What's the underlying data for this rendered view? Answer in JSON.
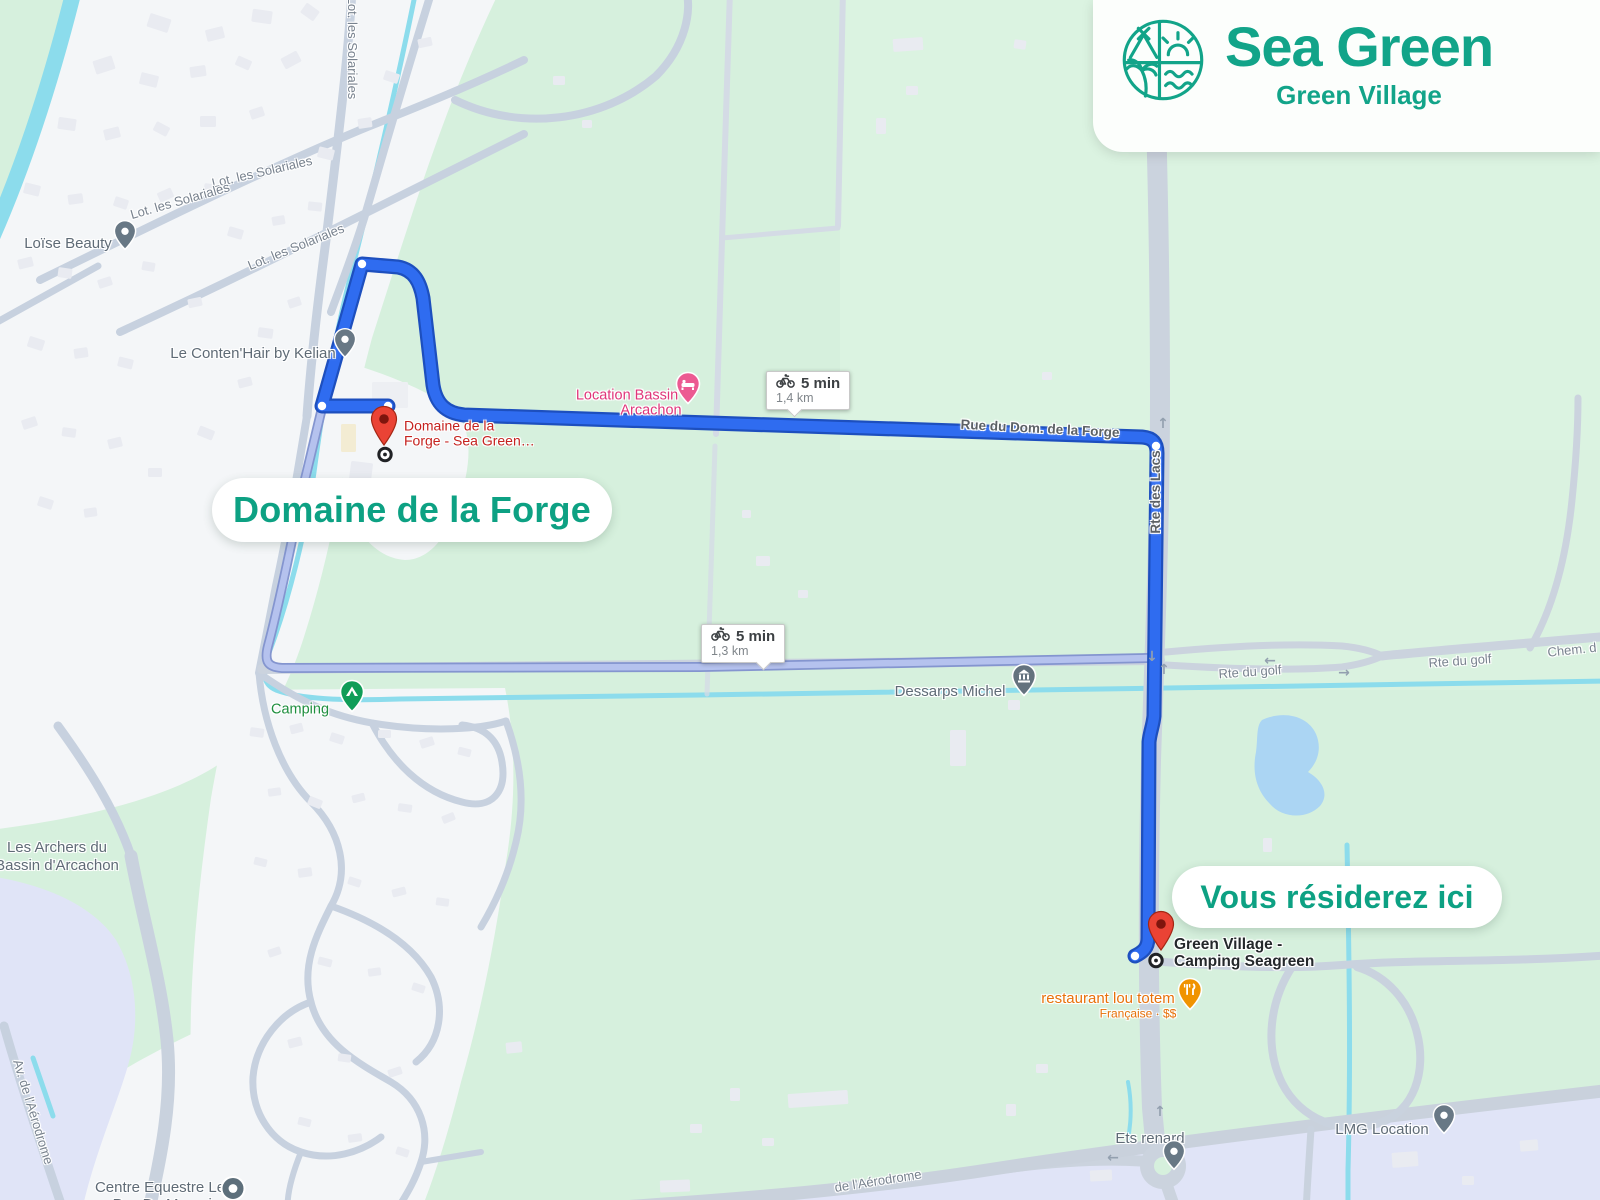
{
  "brand_card": {
    "title": "Sea Green",
    "subtitle": "Green Village",
    "accent_color": "#12a489"
  },
  "callout_pills": [
    {
      "id": "origin",
      "text": "Domaine de la Forge",
      "x": 212,
      "y": 478,
      "w": 400,
      "h": 64,
      "size": "pill-lg"
    },
    {
      "id": "destination",
      "text": "Vous résiderez ici",
      "x": 1172,
      "y": 866,
      "w": 330,
      "h": 62,
      "size": "pill-md"
    }
  ],
  "route_badges": [
    {
      "id": "route-primary-badge",
      "mode": "bicycle",
      "duration": "5 min",
      "distance": "1,4 km",
      "x": 766,
      "y": 371,
      "tail_x": 22
    },
    {
      "id": "route-alternate-badge",
      "mode": "bicycle",
      "duration": "5 min",
      "distance": "1,3 km",
      "x": 701,
      "y": 624,
      "tail_x": 56
    }
  ],
  "markers": [
    {
      "id": "origin-pin",
      "type": "red-pin",
      "x": 384,
      "y": 452
    },
    {
      "id": "origin-ring",
      "type": "target-ring",
      "x": 385,
      "y": 457
    },
    {
      "id": "destination-pin",
      "type": "red-pin",
      "x": 1161,
      "y": 957
    },
    {
      "id": "destination-ring",
      "type": "target-ring",
      "x": 1156,
      "y": 963
    },
    {
      "id": "poi-loise-beauty",
      "type": "gray-pin",
      "x": 125,
      "y": 256
    },
    {
      "id": "poi-contenhair",
      "type": "gray-pin",
      "x": 345,
      "y": 364
    },
    {
      "id": "poi-location-bassin",
      "type": "pink-lodging-pin",
      "x": 688,
      "y": 410
    },
    {
      "id": "poi-dessarps",
      "type": "gray-bank-pin",
      "x": 1024,
      "y": 702
    },
    {
      "id": "poi-camping",
      "type": "green-camping-pin",
      "x": 352,
      "y": 718
    },
    {
      "id": "poi-restaurant",
      "type": "orange-restaurant-pin",
      "x": 1190,
      "y": 1016
    },
    {
      "id": "poi-ets-renard",
      "type": "gray-pin",
      "x": 1174,
      "y": 1176
    },
    {
      "id": "poi-lmg",
      "type": "gray-pin",
      "x": 1444,
      "y": 1140
    },
    {
      "id": "poi-centre-equestre",
      "type": "gray-dot-pin",
      "x": 233,
      "y": 1191
    }
  ],
  "map_labels": [
    {
      "name": "street-lot-les-solariales-1",
      "text": "Lot. les Solariales",
      "x": 352,
      "y": 48,
      "rot": 90,
      "cls": "street"
    },
    {
      "name": "street-lot-les-solariales-2",
      "text": "Lot. les Solariales",
      "x": 262,
      "y": 172,
      "rot": -13,
      "cls": "street"
    },
    {
      "name": "street-lot-les-solariales-3",
      "text": "Lot. les Solariales",
      "x": 180,
      "y": 201,
      "rot": -16,
      "cls": "street"
    },
    {
      "name": "street-lot-les-solariales-4",
      "text": "Lot. les Solariales",
      "x": 296,
      "y": 247,
      "rot": -22,
      "cls": "street"
    },
    {
      "name": "street-rue-du-dom-de-la-forge",
      "text": "Rue du Dom. de la Forge",
      "x": 1040,
      "y": 429,
      "rot": 3,
      "cls": "street on-route"
    },
    {
      "name": "street-rte-des-lacs",
      "text": "Rte des Lacs",
      "x": 1156,
      "y": 492,
      "rot": -90,
      "cls": "street on-route"
    },
    {
      "name": "street-rte-du-golf-1",
      "text": "Rte du golf",
      "x": 1250,
      "y": 672,
      "rot": -4,
      "cls": "street"
    },
    {
      "name": "street-rte-du-golf-2",
      "text": "Rte du golf",
      "x": 1460,
      "y": 661,
      "rot": -4,
      "cls": "street"
    },
    {
      "name": "street-chem-d",
      "text": "Chem. d",
      "x": 1572,
      "y": 650,
      "rot": -6,
      "cls": "street"
    },
    {
      "name": "street-av-aerodrome",
      "text": "Av. de l'Aérodrome",
      "x": 33,
      "y": 1112,
      "rot": 73,
      "cls": "street"
    },
    {
      "name": "street-de-aerodrome",
      "text": "de l'Aérodrome",
      "x": 878,
      "y": 1181,
      "rot": -9,
      "cls": "street"
    },
    {
      "name": "poi-label-loise-beauty",
      "text": "Loïse Beauty",
      "x": 68,
      "y": 244,
      "cls": "poi"
    },
    {
      "name": "poi-label-contenhair",
      "text": "Le Conten'Hair by Kelian",
      "x": 253,
      "y": 354,
      "cls": "poi"
    },
    {
      "name": "poi-label-dessarps",
      "text": "Dessarps Michel",
      "x": 950,
      "y": 692,
      "cls": "poi"
    },
    {
      "name": "poi-label-les-archers-1",
      "text": "Les Archers du",
      "x": 57,
      "y": 848,
      "cls": "poi"
    },
    {
      "name": "poi-label-les-archers-2",
      "text": "Bassin d'Arcachon",
      "x": 57,
      "y": 866,
      "cls": "poi"
    },
    {
      "name": "poi-label-camping",
      "text": "Camping",
      "x": 300,
      "y": 710,
      "cls": "green"
    },
    {
      "name": "poi-label-restaurant",
      "text": "restaurant lou totem",
      "x": 1108,
      "y": 999,
      "cls": "orange"
    },
    {
      "name": "poi-label-restaurant-2",
      "text": "Française · $$",
      "x": 1138,
      "y": 1014,
      "cls": "orange small"
    },
    {
      "name": "poi-label-ets-renard",
      "text": "Ets renard",
      "x": 1150,
      "y": 1139,
      "cls": "poi"
    },
    {
      "name": "poi-label-lmg",
      "text": "LMG Location",
      "x": 1382,
      "y": 1130,
      "cls": "poi"
    },
    {
      "name": "poi-label-centre-equestre-1",
      "text": "Centre Equestre Le",
      "x": 160,
      "y": 1188,
      "cls": "poi"
    },
    {
      "name": "poi-label-centre-equestre-2",
      "text": "Pas Du Marquis",
      "x": 166,
      "y": 1205,
      "cls": "poi"
    },
    {
      "name": "origin-marker-label-1",
      "text": "Domaine de la",
      "x": 404,
      "y": 426,
      "cls": "red left"
    },
    {
      "name": "origin-marker-label-2",
      "text": "Forge - Sea Green…",
      "x": 404,
      "y": 441,
      "cls": "red left"
    },
    {
      "name": "poi-label-location-bassin-1",
      "text": "Location Bassin",
      "x": 627,
      "y": 396,
      "cls": "pink"
    },
    {
      "name": "poi-label-location-bassin-2",
      "text": "Arcachon",
      "x": 651,
      "y": 411,
      "cls": "pink"
    },
    {
      "name": "destination-marker-label-1",
      "text": "Green Village -",
      "x": 1174,
      "y": 945,
      "cls": "dark left"
    },
    {
      "name": "destination-marker-label-2",
      "text": "Camping Seagreen",
      "x": 1174,
      "y": 962,
      "cls": "dark left"
    }
  ],
  "road_arrows": [
    {
      "sym": "↓",
      "x": 1152,
      "y": 657
    },
    {
      "sym": "↑",
      "x": 1164,
      "y": 670
    },
    {
      "sym": "←",
      "x": 1270,
      "y": 661
    },
    {
      "sym": "→",
      "x": 1344,
      "y": 673
    },
    {
      "sym": "←",
      "x": 1113,
      "y": 1158
    },
    {
      "sym": "↑",
      "x": 1160,
      "y": 1112
    },
    {
      "sym": "↑",
      "x": 1163,
      "y": 424
    }
  ]
}
